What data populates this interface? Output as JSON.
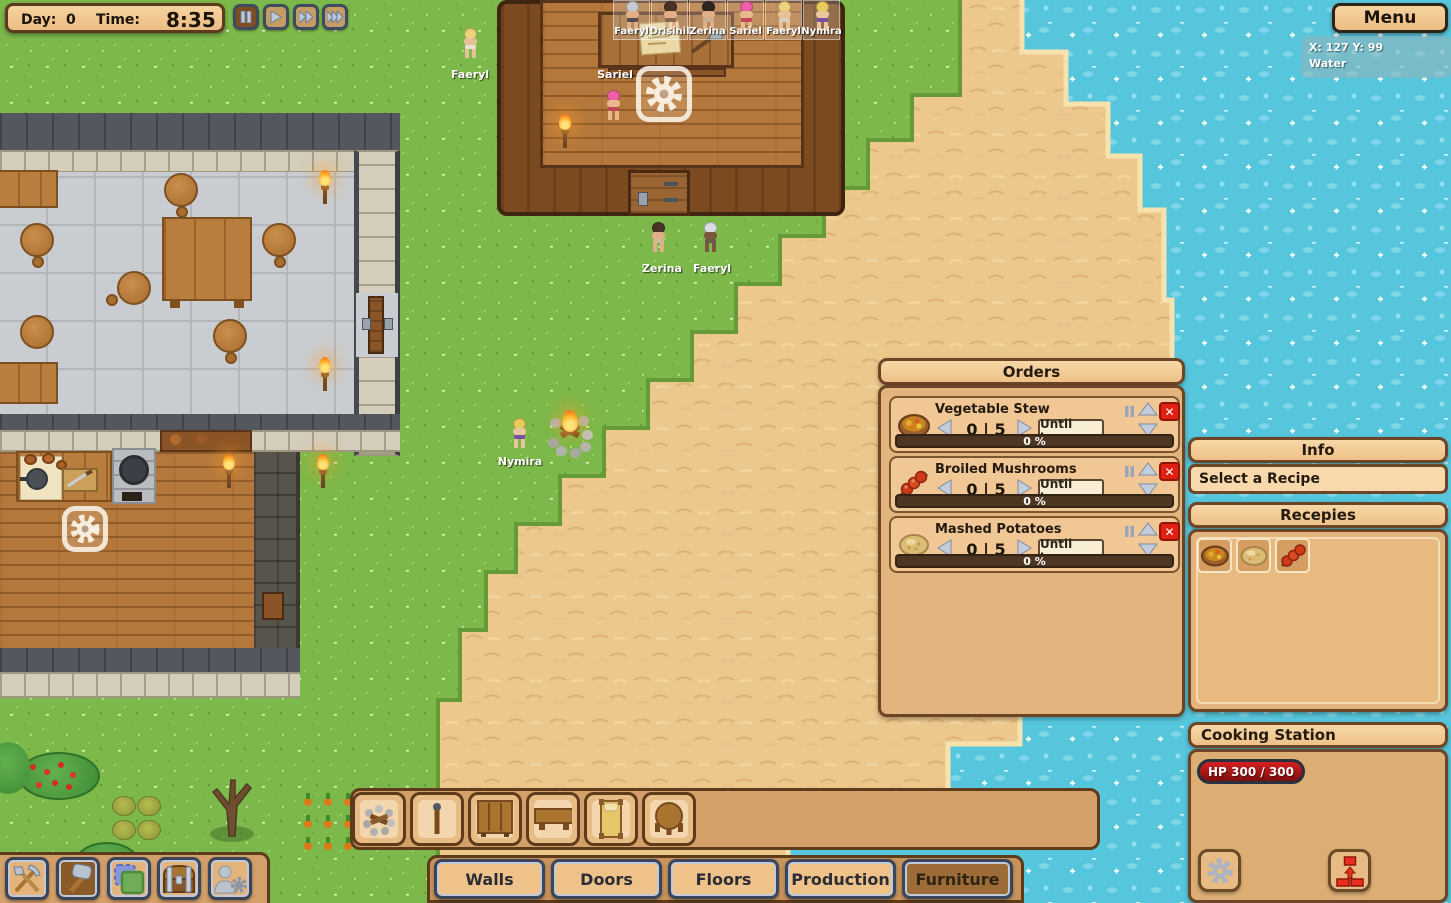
{
  "hud": {
    "day_label": "Day:",
    "day_value": "0",
    "time_label": "Time:",
    "time_value": "8:35",
    "speed_controls": [
      "pause",
      "play",
      "fast-forward",
      "fastest-forward"
    ],
    "menu_label": "Menu",
    "tooltip": {
      "coordinates": "X: 127 Y: 99",
      "terrain": "Water"
    }
  },
  "colonist_bar": {
    "names": [
      "Faeryl",
      "Drisinil",
      "Zerina",
      "Sariel",
      "Faeryl",
      "Nymira"
    ]
  },
  "world": {
    "character_labels": [
      {
        "name": "Faeryl"
      },
      {
        "name": "Sariel"
      },
      {
        "name": "Zerina"
      },
      {
        "name": "Faeryl"
      },
      {
        "name": "Nymira"
      }
    ]
  },
  "orders_panel": {
    "title": "Orders",
    "rows": [
      {
        "name": "Vegetable Stew",
        "icon": "vegetable-stew-icon",
        "count": "0 | 5",
        "mode_button": "Until have",
        "progress": "0 %"
      },
      {
        "name": "Broiled Mushrooms",
        "icon": "broiled-mushrooms-icon",
        "count": "0 | 5",
        "mode_button": "Until have",
        "progress": "0 %"
      },
      {
        "name": "Mashed Potatoes",
        "icon": "mashed-potatoes-icon",
        "count": "0 | 5",
        "mode_button": "Until have",
        "progress": "0 %"
      }
    ]
  },
  "info_panel": {
    "title": "Info",
    "message": "Select a Recipe"
  },
  "recipes_panel": {
    "title": "Recepies",
    "recipe_icons": [
      "vegetable-stew",
      "mashed-potatoes",
      "broiled-mushrooms"
    ]
  },
  "station_panel": {
    "title": "Cooking Station",
    "hp_label": "HP",
    "hp_value": "300 / 300"
  },
  "build_menu": {
    "item_icons": [
      "campfire",
      "torch",
      "dresser",
      "bench-table",
      "bed",
      "round-table"
    ],
    "tabs": [
      "Walls",
      "Doors",
      "Floors",
      "Production",
      "Furniture"
    ],
    "selected_tab": "Furniture"
  },
  "tool_bar": {
    "tool_icons": [
      "harvest-tools",
      "build-hammer",
      "zones",
      "stockpile-chest",
      "colonist-management"
    ],
    "selected_tool": "build-hammer"
  },
  "colors": {
    "panel_tan": "#e3b47d",
    "panel_header": "#f4d09b",
    "panel_border": "#6b4526",
    "hp_red": "#c41414",
    "close_red": "#e02010",
    "progress_brown": "#4e3722",
    "slate_border": "#3c4757",
    "tab_selected": "#9c6b36",
    "grass": "#7cb84a",
    "sand": "#eec98c",
    "water": "#56c6dd"
  }
}
